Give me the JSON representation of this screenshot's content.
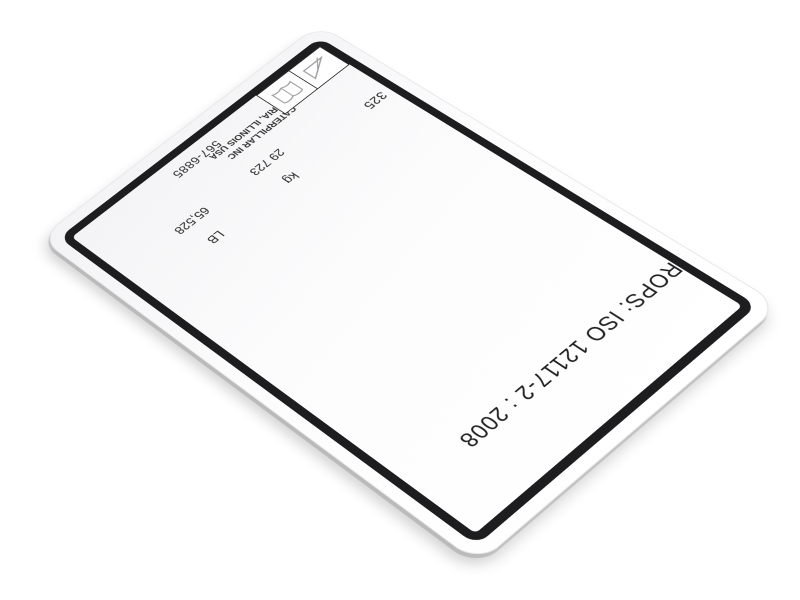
{
  "scene": {
    "background_color": "#ffffff",
    "object": "caterpillar-rops-certification-plate",
    "orientation": "upside-down perspective view"
  },
  "label": {
    "rops_line": "ROPS: ISO 12117-2 : 2008",
    "model": "325",
    "mass": {
      "kg_unit": "kg",
      "kg_value": "29 723",
      "lb_unit": "LB",
      "lb_value": "65,528"
    },
    "manufacturer": {
      "line1": "CATERPILLAR INC",
      "line2": "PEORIA, ILLINOIS USA"
    },
    "part_number": "567-6885",
    "icons": [
      {
        "name": "slope-triangle-icon"
      },
      {
        "name": "operator-manual-icon"
      }
    ],
    "colors": {
      "plate": "#ffffff",
      "border": "#1d1d1f",
      "text": "#2b2b2b",
      "icon_stroke": "#9a9a9e",
      "shadow": "#d9d9dc"
    }
  }
}
